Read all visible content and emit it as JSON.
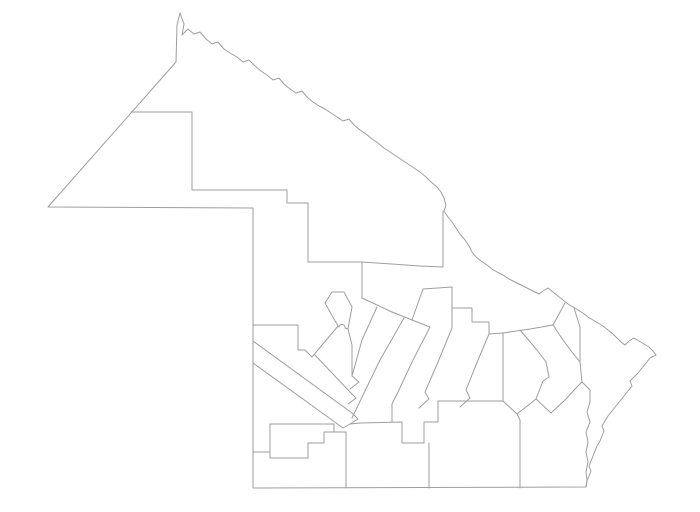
{
  "map": {
    "figure_type": "province-outline-map-with-department-boundaries",
    "background_color": "#ffffff",
    "stroke_color": "#9e9e9e",
    "stroke_width": 1,
    "viewbox": "0 0 700 512",
    "outer_boundary": "M48 207 L176 62 L177 25 L180 13 L184 24 L182 35 L188 29 L194 34 L200 32 L206 39 L212 44 L218 42 L224 49 L230 53 L237 57 L243 62 L249 60 L255 66 L261 71 L267 75 L273 80 L279 78 L284 84 L290 89 L296 93 L302 91 L307 97 L313 102 L319 106 L325 109 L331 113 L337 117 L343 121 L349 119 L354 125 L360 130 L366 134 L372 139 L378 143 L384 148 L390 152 L396 156 L402 160 L408 164 L414 168 L420 172 L426 177 L431 182 L437 187 L441 192 L444 198 L446 205 L444 211 L448 217 L452 222 L456 228 L460 234 L465 240 L469 246 L472 252 L476 257 L481 261 L487 265 L492 269 L497 272 L503 275 L509 279 L515 282 L521 285 L527 288 L533 291 L539 294 L543 291 L548 288 L553 292 L558 296 L563 300 L568 304 L573 307 L578 310 L583 313 L588 317 L593 320 L598 323 L603 326 L608 330 L613 334 L617 338 L621 342 L625 345 L629 341 L634 338 L639 341 L644 344 L649 347 L653 351 L656 355 L650 358 L646 363 L642 368 L638 373 L634 377 L630 381 L632 386 L628 391 L624 396 L620 401 L616 406 L612 411 L608 416 L605 421 L602 426 L604 431 L602 436 L600 441 L597 446 L595 451 L593 456 L591 461 L589 466 L591 471 L589 476 L587 481 L586 487 L253 488 L253 208 Z",
    "internal_boundaries": [
      "M131 112 L192 112 L192 190 L287 190 L287 203 L308 203 L308 262 L362 262",
      "M362 262 L420 266 L443 267",
      "M443 211 L443 267",
      "M362 262 L362 298",
      "M362 298 L392 312 L412 320 L430 327",
      "M253 325 L298 325 L298 350 L305 350 L312 357 L338 326",
      "M338 326 L325 303 L332 292 L344 292 L352 307 L348 329 L345 328 A3 3 0 1 0 339 327 Z",
      "M348 329 L352 345 L352 376",
      "M377 307 L362 340 L352 376 L359 382 L350 389",
      "M315 355 L349 391 L356 398 L348 404",
      "M253 341 L352 413 L358 419 L350 424 L343 428",
      "M253 363 L343 428",
      "M404 318 L380 360 L364 393 L352 418",
      "M430 327 L412 362 L398 392 L392 404 L392 422",
      "M412 320 L423 289 L452 287 L452 308 L472 308 L472 322 L489 322 L489 334 L503 333",
      "M452 308 L452 328 L438 362 L425 392 L429 399 L419 408",
      "M489 334 L478 360 L466 390 L470 398 L460 407",
      "M503 333 L503 401",
      "M503 333 L530 329 L553 325 L565 303",
      "M553 325 L563 340 L572 352 L580 362",
      "M520 330 L537 350 L546 362 L549 377 L543 381 L536 399",
      "M503 401 L517 414 L536 399 L551 413 L566 399",
      "M566 399 L575 389 L582 382",
      "M574 308 L580 327 L580 362 L582 382 L590 390 L590 402 L587 412 L590 422 L586 432 L588 442 L586 452 L588 462 L586 472 L587 480 L586 487",
      "M350 424 L360 423 L402 422 L402 443 L424 443 L424 422 L438 422 L438 401 L503 401",
      "M429 443 L429 488",
      "M517 414 L520 420 L520 488",
      "M253 452 L270 452",
      "M270 424 L270 458",
      "M270 424 L334 424",
      "M334 424 L334 432",
      "M324 432 L346 432",
      "M308 458 L308 443 L324 443 L324 432",
      "M270 458 L308 458",
      "M346 432 L346 488"
    ]
  }
}
